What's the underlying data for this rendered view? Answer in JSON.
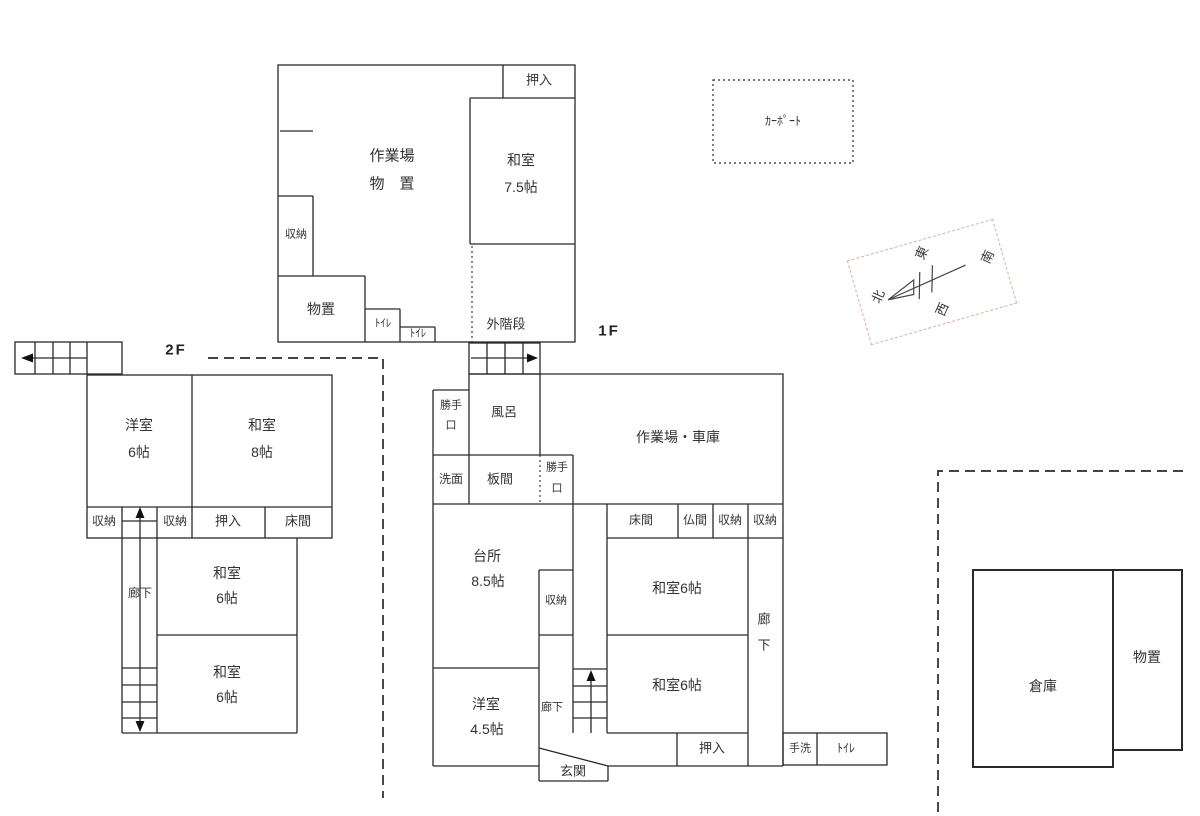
{
  "colors": {
    "wall": "#2a2a2a",
    "text": "#333333",
    "compass_border": "#dfae9f"
  },
  "titles": {
    "second_floor": "2F",
    "first_floor": "1F"
  },
  "carport": {
    "label": "ｶｰﾎﾟｰﾄ"
  },
  "compass": {
    "north": "北",
    "east": "東",
    "south": "南",
    "west": "西"
  },
  "annex": {
    "oshiire": "押入",
    "washitsu_name": "和室",
    "washitsu_size": "7.5帖",
    "workshop_line1": "作業場",
    "workshop_line2": "物　置",
    "shuno": "収納",
    "monooki": "物置",
    "toilet_a": "ﾄｲﾚ",
    "toilet_b": "ﾄｲﾚ",
    "outside_stairs": "外階段"
  },
  "second_floor": {
    "yoshitsu_name": "洋室",
    "yoshitsu_size": "6帖",
    "washitsu8_name": "和室",
    "washitsu8_size": "8帖",
    "shuno_left": "収納",
    "shuno_right": "収納",
    "oshiire": "押入",
    "tokonoma": "床間",
    "rouka": "廊下",
    "washitsu6a_name": "和室",
    "washitsu6a_size": "6帖",
    "washitsu6b_name": "和室",
    "washitsu6b_size": "6帖"
  },
  "first_floor": {
    "katteguchi_nw_l1": "勝手",
    "katteguchi_nw_l2": "口",
    "furo": "風呂",
    "senmen": "洗面",
    "itanoma": "板間",
    "katteguchi_mid_l1": "勝手",
    "katteguchi_mid_l2": "口",
    "garage": "作業場・車庫",
    "tokonoma": "床間",
    "butsuma": "仏間",
    "shuno_a": "収納",
    "shuno_b": "収納",
    "kitchen_name": "台所",
    "kitchen_size": "8.5帖",
    "kitchen_shuno": "収納",
    "washitsu_a": "和室6帖",
    "washitsu_b": "和室6帖",
    "rouka_east_l1": "廊",
    "rouka_east_l2": "下",
    "rouka_small": "廊下",
    "yoshitsu_name": "洋室",
    "yoshitsu_size": "4.5帖",
    "genkan": "玄関",
    "oshiire": "押入",
    "tearai": "手洗",
    "toilet": "ﾄｲﾚ"
  },
  "outbuildings": {
    "souko": "倉庫",
    "monooki": "物置"
  }
}
